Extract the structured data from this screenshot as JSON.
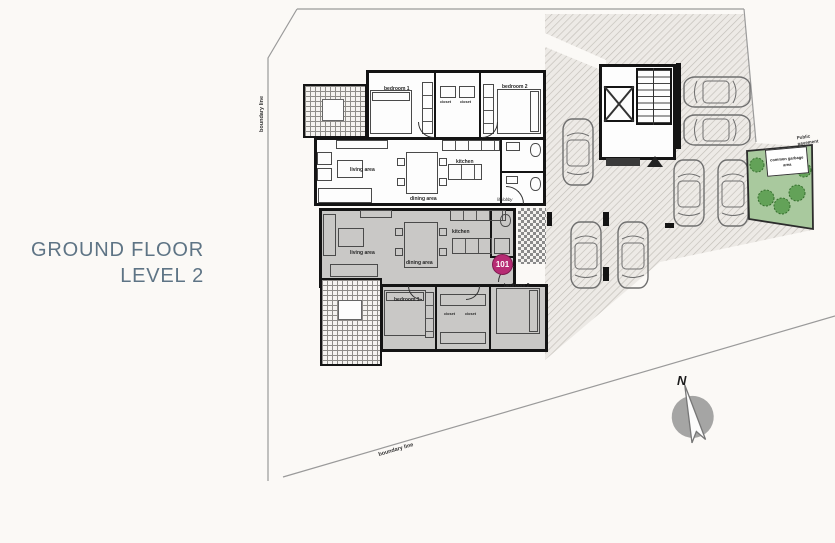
{
  "title": {
    "line1": "GROUND FLOOR",
    "line2": "LEVEL 2"
  },
  "boundary": {
    "left_label": "boundary line",
    "bottom_label": "boundary line"
  },
  "north": {
    "label": "N"
  },
  "site": {
    "public_pavement_label": "Public pavement",
    "garbage_area_label": "common garbage area"
  },
  "unit101": {
    "badge": "101",
    "living_label": "living area",
    "dining_label": "dining area",
    "kitchen_label": "kitchen",
    "bedroom1_label": "bedroom 1",
    "bedroom2_label": "bedroom 2",
    "closet1_label": "closet",
    "closet2_label": "closet"
  },
  "unit_upper": {
    "bedroom1_label": "bedroom 1",
    "bedroom2_label": "bedroom 2",
    "closet1_label": "closet",
    "closet2_label": "closet",
    "kitchen_label": "kitchen",
    "living_label": "living area",
    "dining_label": "dining area",
    "lobby_label": "lift lobby"
  },
  "colors": {
    "title_text": "#5e7485",
    "badge_accent": "#b72c74",
    "highlight_unit_fill": "#c9c8c6",
    "garden_green": "#a9c99e",
    "hatch_line": "#c2beb8"
  }
}
